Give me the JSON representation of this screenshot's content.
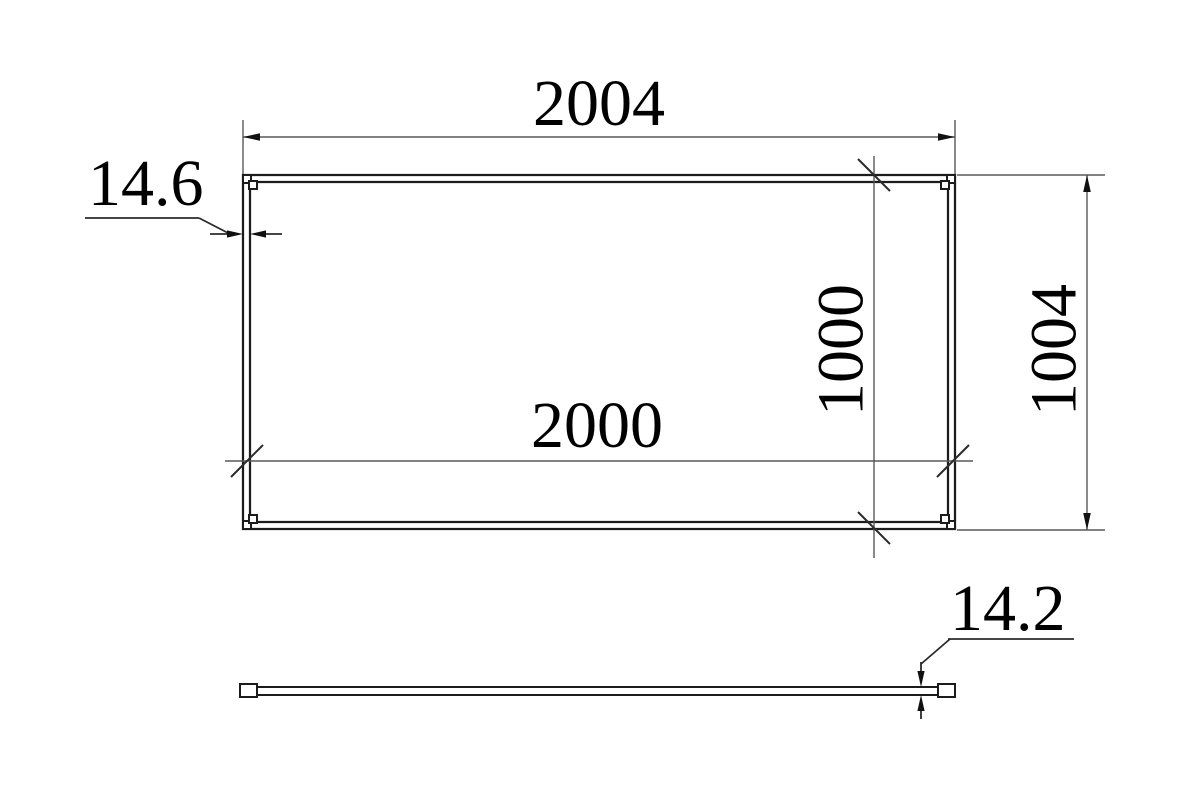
{
  "drawing_title": "panel-dimension-drawing",
  "colors": {
    "background": "#ffffff",
    "object_line": "#1c1c1c",
    "dimension_line": "#595959",
    "tick_line": "#2b2b2b",
    "text": "#000000"
  },
  "plan_view": {
    "outer_width_label": "2004",
    "inner_width_label": "2000",
    "outer_height_label": "1004",
    "inner_height_label": "1000",
    "frame_thickness_label": "14.6"
  },
  "side_view": {
    "profile_thickness_label": "14.2"
  }
}
